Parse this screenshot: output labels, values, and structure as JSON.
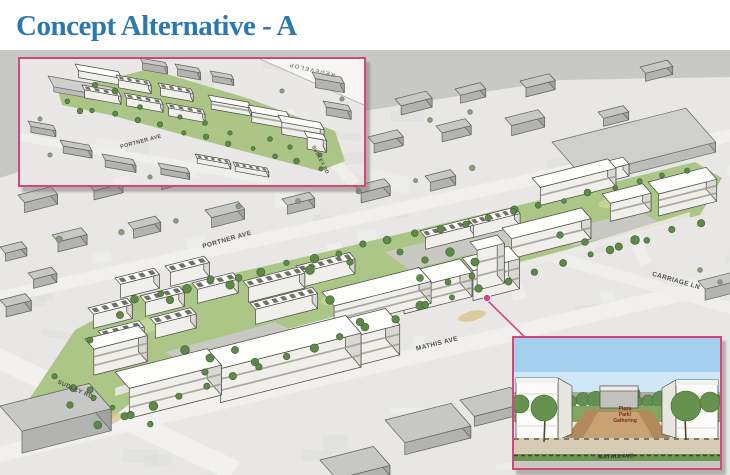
{
  "slide": {
    "title": "Concept Alternative - A"
  },
  "main_view": {
    "labels": {
      "portner_ave": "PORTNER AVE",
      "carriage_ln": "CARRIAGE LN",
      "mathis_ave": "MATHIS AVE",
      "sudley_rd": "SUDLEY RD"
    }
  },
  "inset_overview": {
    "labels": {
      "portner_ave": "PORTNER AVE",
      "sudley_rd": "SUDLEY RD",
      "plan_note": "REDEVELOP"
    }
  },
  "inset_streetview": {
    "plaza_line1": "Plaza",
    "plaza_line2": "Park/",
    "plaza_line3": "Gathering",
    "mathis_ave": "MATHIS AVE"
  },
  "colors": {
    "title_blue": "#2d78ad",
    "callout_pink": "#d5457e",
    "proposal_green": "#a9c483",
    "tree_green": "#5d8a49",
    "sky_blue": "#a3d0ec",
    "plaza_tan": "#b3895c"
  }
}
